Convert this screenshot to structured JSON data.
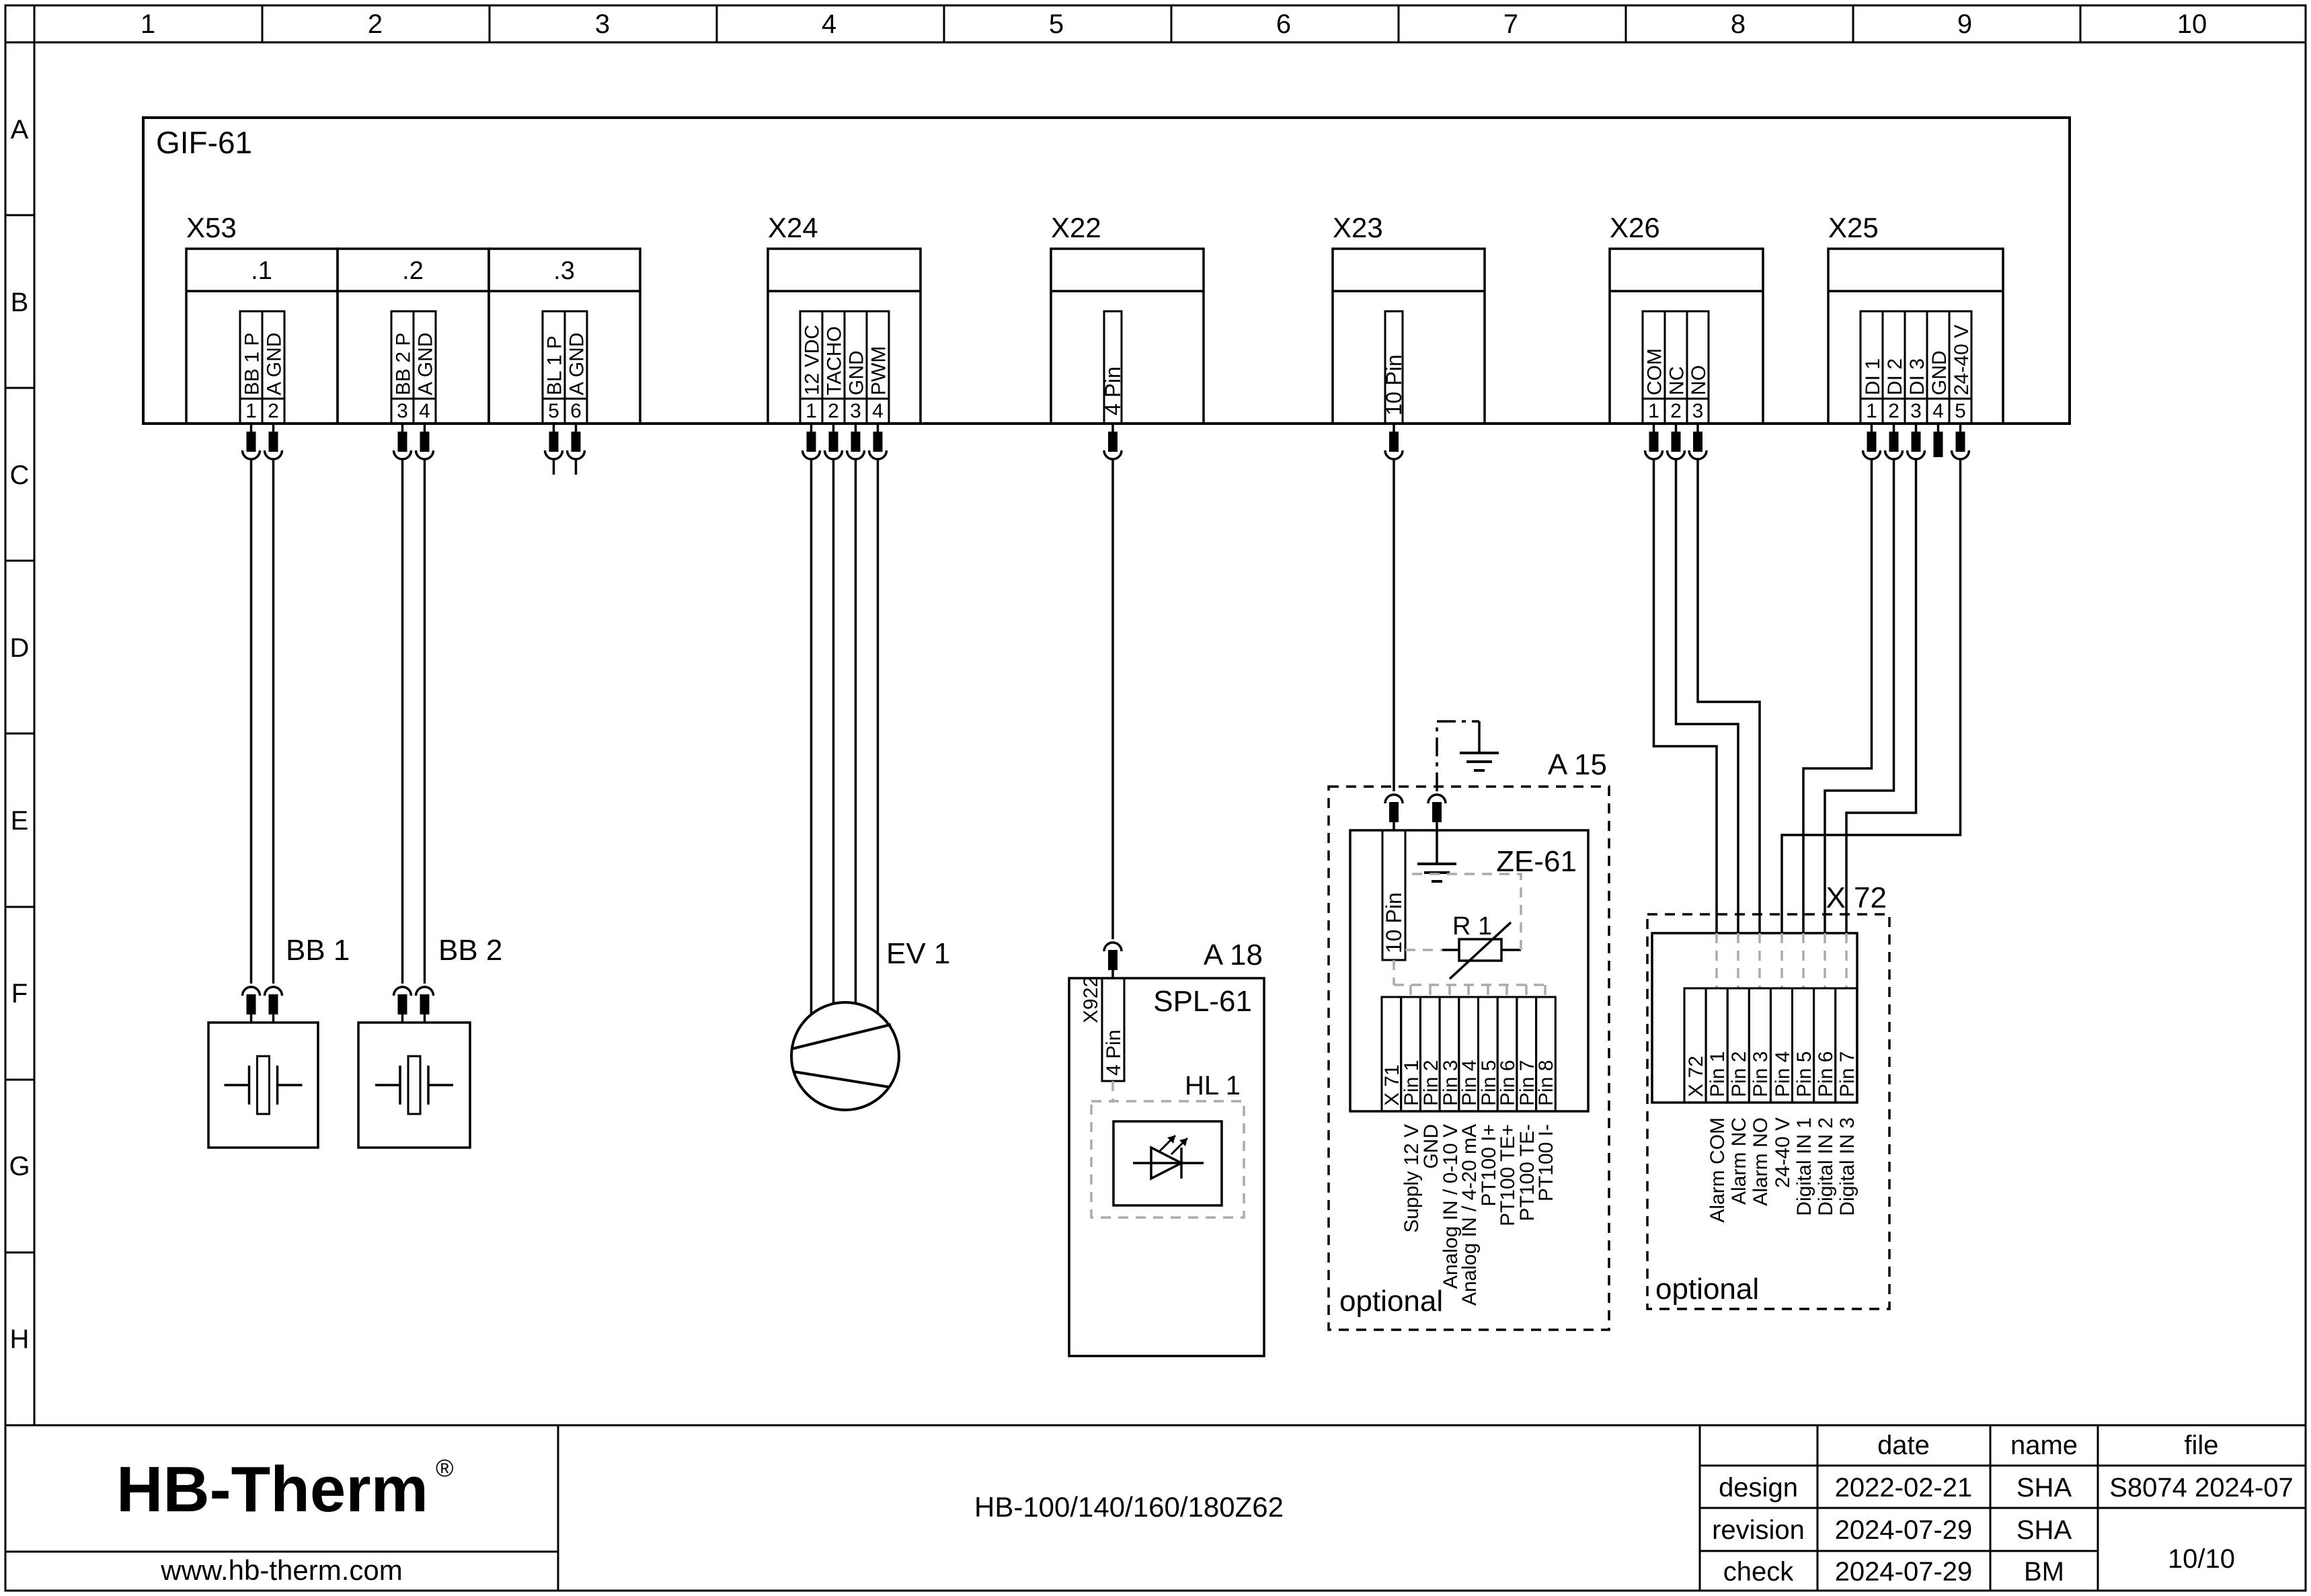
{
  "grid": {
    "columns": [
      "1",
      "2",
      "3",
      "4",
      "5",
      "6",
      "7",
      "8",
      "9",
      "10"
    ],
    "rows": [
      "A",
      "B",
      "C",
      "D",
      "E",
      "F",
      "G",
      "H"
    ]
  },
  "board": {
    "label": "GIF-61"
  },
  "connectors": {
    "x53": {
      "label": "X53",
      "groups": [
        {
          "label": ".1",
          "pins": [
            {
              "n": "1",
              "signal": "BB 1 P"
            },
            {
              "n": "2",
              "signal": "A GND"
            }
          ]
        },
        {
          "label": ".2",
          "pins": [
            {
              "n": "3",
              "signal": "BB 2 P"
            },
            {
              "n": "4",
              "signal": "A GND"
            }
          ]
        },
        {
          "label": ".3",
          "pins": [
            {
              "n": "5",
              "signal": "BL 1 P"
            },
            {
              "n": "6",
              "signal": "A GND"
            }
          ]
        }
      ]
    },
    "x24": {
      "label": "X24",
      "pins": [
        {
          "n": "1",
          "signal": "12 VDC"
        },
        {
          "n": "2",
          "signal": "TACHO"
        },
        {
          "n": "3",
          "signal": "GND"
        },
        {
          "n": "4",
          "signal": "PWM"
        }
      ]
    },
    "x22": {
      "label": "X22",
      "pin": "4 Pin"
    },
    "x23": {
      "label": "X23",
      "pin": "10 Pin"
    },
    "x26": {
      "label": "X26",
      "pins": [
        {
          "n": "1",
          "signal": "COM"
        },
        {
          "n": "2",
          "signal": "NC"
        },
        {
          "n": "3",
          "signal": "NO"
        }
      ]
    },
    "x25": {
      "label": "X25",
      "pins": [
        {
          "n": "1",
          "signal": "DI 1"
        },
        {
          "n": "2",
          "signal": "DI 2"
        },
        {
          "n": "3",
          "signal": "DI 3"
        },
        {
          "n": "4",
          "signal": "GND"
        },
        {
          "n": "5",
          "signal": "24-40 V"
        }
      ]
    }
  },
  "devices": {
    "bb1": {
      "label": "BB 1"
    },
    "bb2": {
      "label": "BB 2"
    },
    "ev1": {
      "label": "EV 1"
    },
    "spl": {
      "ref": "A 18",
      "name": "SPL-61",
      "connector": "X922",
      "pin": "4 Pin",
      "lamp": "HL 1"
    },
    "ze": {
      "ref": "A 15",
      "name": "ZE-61",
      "pin": "10 Pin",
      "resistor": "R 1",
      "optional": "optional",
      "x71": {
        "cells": [
          "X 71",
          "Pin 1",
          "Pin 2",
          "Pin 3",
          "Pin 4",
          "Pin 5",
          "Pin 6",
          "Pin 7",
          "Pin 8"
        ],
        "signals": [
          "Supply 12 V",
          "GND",
          "Analog IN / 0-10 V",
          "Analog IN / 4-20 mA",
          "PT100 I+",
          "PT100 TE+",
          "PT100 TE-",
          "PT100 I-"
        ]
      }
    },
    "x72": {
      "ref": "X 72",
      "optional": "optional",
      "cells": [
        "X 72",
        "Pin 1",
        "Pin 2",
        "Pin 3",
        "Pin 4",
        "Pin 5",
        "Pin 6",
        "Pin 7"
      ],
      "signals": [
        "Alarm COM",
        "Alarm NC",
        "Alarm NO",
        "24-40 V",
        "Digital IN 1",
        "Digital IN 2",
        "Digital IN 3"
      ]
    }
  },
  "titleblock": {
    "logo": "HB-Therm",
    "registered": "®",
    "website": "www.hb-therm.com",
    "drawing_title": "HB-100/140/160/180Z62",
    "headers": {
      "date": "date",
      "name": "name",
      "file": "file"
    },
    "rows": [
      {
        "label": "design",
        "date": "2022-02-21",
        "name": "SHA"
      },
      {
        "label": "revision",
        "date": "2024-07-29",
        "name": "SHA"
      },
      {
        "label": "check",
        "date": "2024-07-29",
        "name": "BM"
      }
    ],
    "file_ref": "S8074 2024-07",
    "sheet": "10/10"
  },
  "colors": {
    "line": "#000000",
    "grey_dashed": "#ababab",
    "logo_navy": "#1c2b45"
  }
}
